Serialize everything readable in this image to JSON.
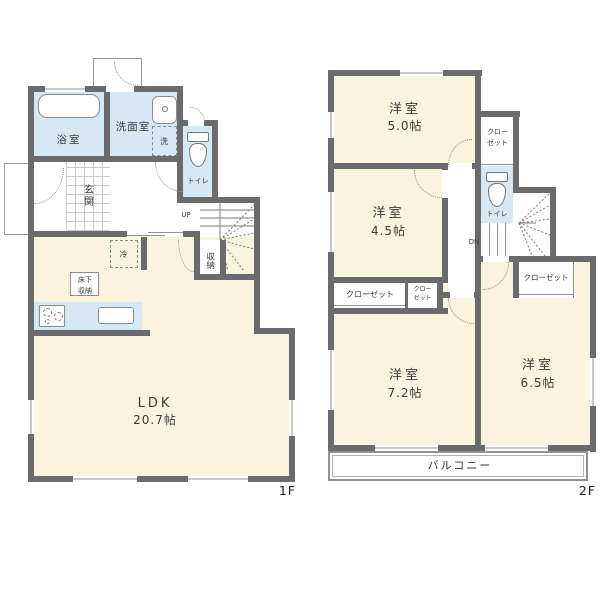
{
  "colors": {
    "wall": "#696B6D",
    "room_fill": "#FAF4DE",
    "wet_area_fill": "#D5E8F4",
    "thin_line": "#8F9193"
  },
  "f1": {
    "tag": "1F",
    "bath": "浴室",
    "washroom": "洗面室",
    "laundry": "洗",
    "toilet": "トイレ",
    "entrance": "玄関",
    "up": "UP",
    "storage": "収納",
    "fridge": "冷",
    "underfloor": "床下収納",
    "ldk": "LDK",
    "ldk_size": "20.7帖"
  },
  "f2": {
    "tag": "2F",
    "room50": "洋室",
    "room50_size": "5.0帖",
    "room45": "洋室",
    "room45_size": "4.5帖",
    "room72": "洋室",
    "room72_size": "7.2帖",
    "room65": "洋室",
    "room65_size": "6.5帖",
    "closet_ne": "クローゼット",
    "closet_l": "クローゼット",
    "closet_s": "クローゼット",
    "closet_r": "クローゼット",
    "toilet": "トイレ",
    "dn": "DN",
    "balcony": "バルコニー"
  }
}
